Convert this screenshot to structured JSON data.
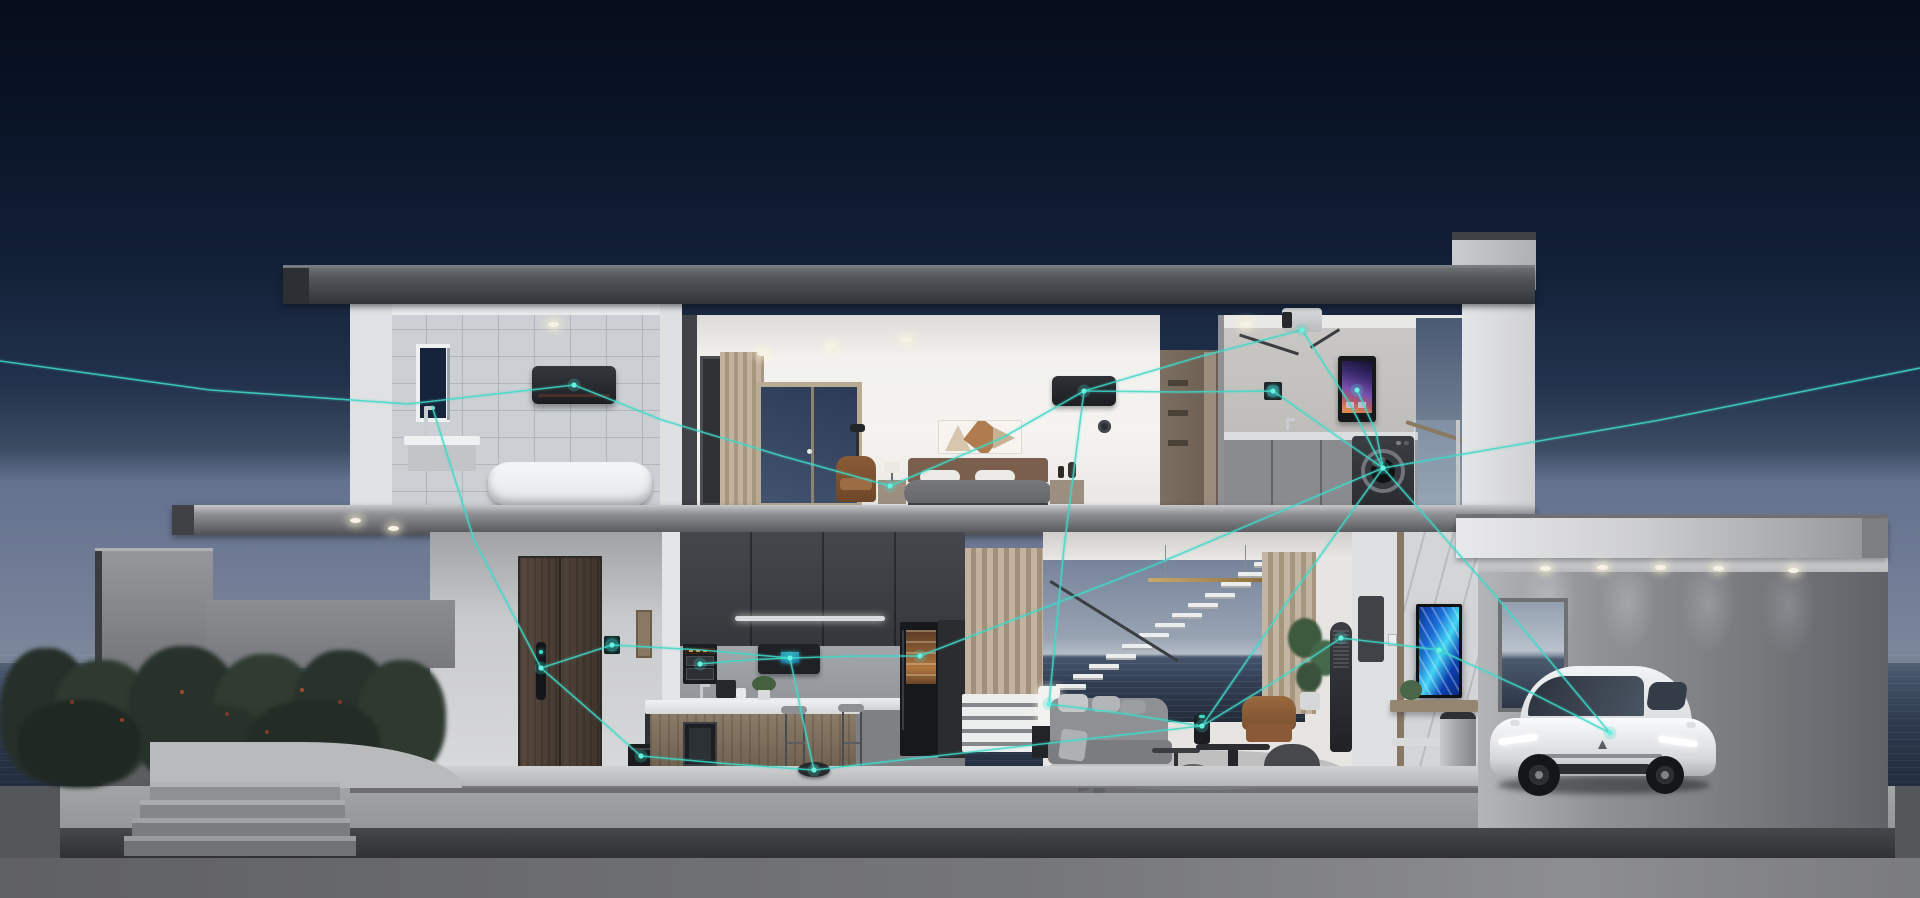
{
  "meta": {
    "title": "Smart home cutaway 3D render at dusk",
    "type": "3d-architectural-render",
    "time_of_day": "dusk",
    "visible_text": "none",
    "watermark": "none"
  },
  "palette": {
    "accent": "#3FD9C9",
    "node_core": "#66F2E0",
    "sky_top": "#060D1C",
    "sky_horizon": "#64718F",
    "ocean_dark": "#1D2633",
    "roof_gray": "#44474C",
    "wall_white": "#E9EAEC",
    "wood_door": "#4A3F36",
    "curtain_beige": "#BCAB97",
    "car_white": "#E8E9EB",
    "hedge_green": "#2B362C"
  },
  "rooms": [
    {
      "id": "bathroom",
      "floor": 2,
      "objects": [
        "window",
        "mirror-partition",
        "faucet",
        "vanity",
        "bathtub",
        "wall-ac-unit",
        "ceiling-light"
      ]
    },
    {
      "id": "bedroom",
      "floor": 2,
      "objects": [
        "hall-door",
        "curtain",
        "window",
        "floor-lamp",
        "armchair",
        "nightstand-left",
        "bed",
        "pillows",
        "wall-art",
        "nightstand-right",
        "wall-ac-unit",
        "round-sensor",
        "downlights"
      ]
    },
    {
      "id": "closet-hallway",
      "floor": 2,
      "objects": [
        "wardrobe-shelves"
      ]
    },
    {
      "id": "laundry",
      "floor": 2,
      "objects": [
        "ceiling-projector",
        "thermostat-panel",
        "smart-water-heater",
        "faucet",
        "cabinets",
        "washing-machine",
        "glass-balustrade"
      ]
    },
    {
      "id": "entry",
      "floor": 1,
      "objects": [
        "double-wood-door",
        "smart-door-lock",
        "entry-control-panel",
        "picture-frame",
        "floor-speaker"
      ]
    },
    {
      "id": "kitchen",
      "floor": 1,
      "objects": [
        "dark-upper-cabinets",
        "under-cabinet-light",
        "wall-oven",
        "smart-range-hood",
        "backsplash",
        "counter",
        "faucet",
        "coffee-machine",
        "assistant-camera",
        "plant",
        "island",
        "wine-cooler",
        "bar-stool",
        "bar-stool",
        "smart-fridge",
        "robot-vacuum"
      ]
    },
    {
      "id": "living-room",
      "floor": 1,
      "objects": [
        "slat-curtain-left",
        "white-slat-bench",
        "ocean-view-opening",
        "floating-stairs",
        "handrail",
        "gold-pendant",
        "table-lamp",
        "side-table",
        "sofa",
        "cushions",
        "coffee-tables",
        "smart-speaker",
        "leather-armchair",
        "bean-bag",
        "pouf",
        "plant",
        "air-purifier-tower",
        "rug",
        "slippers",
        "slat-curtain-right"
      ]
    },
    {
      "id": "media-wall",
      "floor": 1,
      "objects": [
        "coat-panel",
        "light-switch",
        "marble-wall",
        "vertical-tv",
        "console-shelf",
        "plant",
        "smart-trash-can"
      ]
    },
    {
      "id": "garage",
      "floor": 1,
      "objects": [
        "flat-roof",
        "downlights",
        "rear-window",
        "white-suv-car"
      ]
    },
    {
      "id": "garden",
      "floor": 0,
      "objects": [
        "privacy-wall",
        "hedge-wall",
        "bushes",
        "red-berries",
        "curved-retaining-wall",
        "entry-steps",
        "ocean",
        "platform"
      ]
    }
  ],
  "network": {
    "color": "#3FD9C9",
    "glow_color": "#3FD9C9",
    "nodes": [
      {
        "id": "bathroom-ac",
        "x": 574,
        "y": 385
      },
      {
        "id": "door-lock",
        "x": 541,
        "y": 668
      },
      {
        "id": "entry-panel",
        "x": 612,
        "y": 645
      },
      {
        "id": "range-hood",
        "x": 790,
        "y": 658
      },
      {
        "id": "wall-oven",
        "x": 700,
        "y": 664
      },
      {
        "id": "smart-fridge",
        "x": 920,
        "y": 656
      },
      {
        "id": "robot-vacuum",
        "x": 814,
        "y": 770
      },
      {
        "id": "floor-speaker",
        "x": 641,
        "y": 756
      },
      {
        "id": "bedside",
        "x": 890,
        "y": 486
      },
      {
        "id": "bedroom-ac",
        "x": 1084,
        "y": 391
      },
      {
        "id": "thermostat",
        "x": 1273,
        "y": 391
      },
      {
        "id": "water-heater",
        "x": 1357,
        "y": 390
      },
      {
        "id": "washing-machine",
        "x": 1383,
        "y": 468
      },
      {
        "id": "projector",
        "x": 1302,
        "y": 330
      },
      {
        "id": "table-lamp",
        "x": 1049,
        "y": 704
      },
      {
        "id": "living-speaker",
        "x": 1202,
        "y": 726
      },
      {
        "id": "air-purifier",
        "x": 1341,
        "y": 638
      },
      {
        "id": "vertical-tv",
        "x": 1439,
        "y": 650
      },
      {
        "id": "car",
        "x": 1610,
        "y": 733
      }
    ],
    "edges": [
      [
        [
          0,
          361
        ],
        [
          210,
          390
        ],
        [
          408,
          404
        ],
        [
          574,
          385
        ]
      ],
      [
        [
          574,
          385
        ],
        [
          662,
          420
        ],
        [
          782,
          456
        ],
        [
          890,
          486
        ]
      ],
      [
        [
          890,
          486
        ],
        [
          1002,
          438
        ],
        [
          1084,
          391
        ]
      ],
      [
        [
          1084,
          391
        ],
        [
          1202,
          356
        ],
        [
          1302,
          330
        ]
      ],
      [
        [
          1084,
          391
        ],
        [
          1180,
          392
        ],
        [
          1273,
          391
        ]
      ],
      [
        [
          1302,
          330
        ],
        [
          1350,
          404
        ],
        [
          1383,
          468
        ]
      ],
      [
        [
          1273,
          391
        ],
        [
          1334,
          434
        ],
        [
          1383,
          468
        ]
      ],
      [
        [
          1357,
          390
        ],
        [
          1376,
          432
        ],
        [
          1383,
          468
        ]
      ],
      [
        [
          1383,
          468
        ],
        [
          1494,
          594
        ],
        [
          1610,
          733
        ]
      ],
      [
        [
          1383,
          468
        ],
        [
          1290,
          598
        ],
        [
          1202,
          726
        ]
      ],
      [
        [
          1383,
          468
        ],
        [
          1660,
          420
        ],
        [
          1920,
          368
        ]
      ],
      [
        [
          432,
          406
        ],
        [
          474,
          540
        ],
        [
          541,
          668
        ]
      ],
      [
        [
          541,
          668
        ],
        [
          612,
          645
        ]
      ],
      [
        [
          612,
          645
        ],
        [
          702,
          650
        ],
        [
          790,
          658
        ]
      ],
      [
        [
          790,
          658
        ],
        [
          858,
          656
        ],
        [
          920,
          656
        ]
      ],
      [
        [
          790,
          658
        ],
        [
          802,
          716
        ],
        [
          814,
          770
        ]
      ],
      [
        [
          541,
          668
        ],
        [
          596,
          716
        ],
        [
          641,
          756
        ]
      ],
      [
        [
          641,
          756
        ],
        [
          730,
          764
        ],
        [
          814,
          770
        ]
      ],
      [
        [
          814,
          770
        ],
        [
          1006,
          748
        ],
        [
          1202,
          726
        ]
      ],
      [
        [
          1202,
          726
        ],
        [
          1274,
          682
        ],
        [
          1341,
          638
        ]
      ],
      [
        [
          1341,
          638
        ],
        [
          1392,
          644
        ],
        [
          1439,
          650
        ]
      ],
      [
        [
          1439,
          650
        ],
        [
          1526,
          690
        ],
        [
          1610,
          733
        ]
      ],
      [
        [
          920,
          656
        ],
        [
          1152,
          566
        ],
        [
          1383,
          468
        ]
      ],
      [
        [
          1202,
          726
        ],
        [
          1126,
          714
        ],
        [
          1049,
          704
        ]
      ],
      [
        [
          1084,
          391
        ],
        [
          1064,
          548
        ],
        [
          1049,
          704
        ]
      ],
      [
        [
          790,
          658
        ],
        [
          746,
          660
        ],
        [
          700,
          664
        ]
      ]
    ]
  },
  "decor": {
    "stairs": {
      "x": 1056,
      "y": 562,
      "steps": 13,
      "dx": 16.5,
      "dy": 10.2
    },
    "garage_lights": [
      [
        1540,
        566
      ],
      [
        1597,
        565
      ],
      [
        1655,
        565
      ],
      [
        1713,
        566
      ],
      [
        1788,
        568
      ]
    ],
    "bedroom_lights": [
      [
        757,
        351
      ],
      [
        826,
        344
      ],
      [
        901,
        337
      ]
    ],
    "canopy_lights": [
      [
        350,
        518
      ],
      [
        388,
        526
      ]
    ],
    "bathroom_light": [
      [
        548,
        322
      ]
    ],
    "laundry_light": [
      [
        1240,
        322
      ]
    ],
    "bushes": [
      [
        0,
        648,
        92,
        132,
        "#26302A"
      ],
      [
        52,
        660,
        102,
        122,
        "#2E3A30"
      ],
      [
        128,
        646,
        112,
        136,
        "#27322B"
      ],
      [
        212,
        654,
        106,
        128,
        "#303C31"
      ],
      [
        292,
        650,
        102,
        130,
        "#28332C"
      ],
      [
        358,
        660,
        88,
        118,
        "#2E3A2F"
      ],
      [
        18,
        700,
        122,
        88,
        "#1F2823"
      ],
      [
        148,
        704,
        122,
        80,
        "#28322A"
      ],
      [
        248,
        700,
        132,
        84,
        "#232D26"
      ]
    ],
    "berries": [
      [
        70,
        700,
        "#7D3A2A"
      ],
      [
        180,
        690,
        "#A04A30"
      ],
      [
        225,
        712,
        "#7D3A2A"
      ],
      [
        300,
        688,
        "#A04A30"
      ],
      [
        338,
        700,
        "#7D3A2A"
      ],
      [
        120,
        718,
        "#8A4029"
      ],
      [
        265,
        730,
        "#7D3A2A"
      ]
    ]
  }
}
